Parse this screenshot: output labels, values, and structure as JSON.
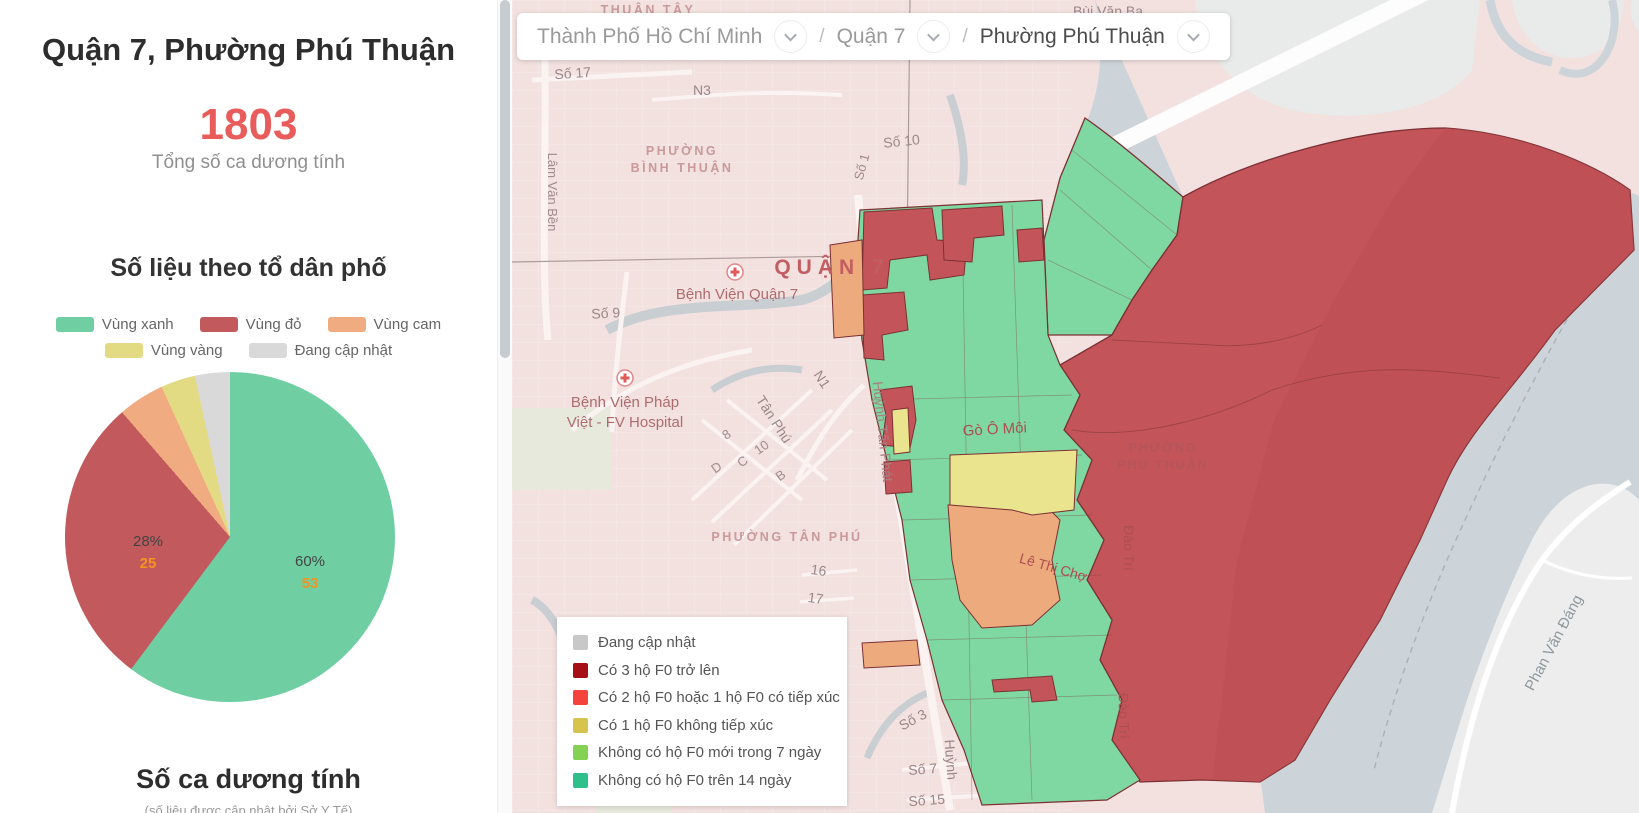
{
  "page": {
    "title": "Quận 7, Phường Phú Thuận"
  },
  "sidebar": {
    "title": "Quận 7, Phường Phú Thuận",
    "total_cases": "1803",
    "total_cases_label": "Tổng số ca dương tính",
    "section_title": "Số liệu theo tổ dân phố",
    "bottom_section_title": "Số ca dương tính",
    "bottom_section_subtitle": "(số liệu được cập nhật bởi Sở Y Tế)"
  },
  "chart_data": {
    "type": "pie",
    "title": "Số liệu theo tổ dân phố",
    "unit": "tổ dân phố",
    "start_angle": "12 o'clock",
    "direction": "clockwise",
    "legend_position": "top",
    "slices": [
      {
        "label": "Vùng xanh",
        "value": 53,
        "color": "#6fcfa3"
      },
      {
        "label": "Vùng đỏ",
        "value": 25,
        "color": "#c2595c"
      },
      {
        "label": "Vùng cam",
        "value": 4,
        "color": "#f1ab81"
      },
      {
        "label": "Vùng vàng",
        "value": 3,
        "color": "#e3da84"
      },
      {
        "label": "Đang cập nhật",
        "value": 3,
        "color": "#d9d9d9"
      }
    ],
    "displayed_labels": [
      {
        "slice": "Vùng xanh",
        "pct": "60%",
        "value": "53"
      },
      {
        "slice": "Vùng đỏ",
        "pct": "28%",
        "value": "25"
      }
    ]
  },
  "breadcrumb": {
    "separator": "/",
    "items": [
      {
        "label": "Thành Phố Hồ Chí Minh"
      },
      {
        "label": "Quận 7"
      },
      {
        "label": "Phường Phú Thuận"
      }
    ]
  },
  "map_legend": {
    "items": [
      {
        "label": "Đang cập nhật",
        "color": "#c8c8c8"
      },
      {
        "label": "Có 3 hộ F0 trở lên",
        "color": "#a50f15"
      },
      {
        "label": "Có 2 hộ F0 hoặc 1 hộ F0 có tiếp xúc",
        "color": "#f4433c"
      },
      {
        "label": "Có 1 hộ F0 không tiếp xúc",
        "color": "#d6c44f"
      },
      {
        "label": "Không có hộ F0 mới trong 7 ngày",
        "color": "#84d154"
      },
      {
        "label": "Không có hộ F0 trên 14 ngày",
        "color": "#2fbf8a"
      }
    ]
  },
  "map": {
    "labels": {
      "thuan_tay": "THUẬN TÂY",
      "bui_van_ba": "Bùi Văn Ba",
      "so_17": "Số 17",
      "n3": "N3",
      "so_1": "Số 1",
      "so_10": "Số 10",
      "phuong_binh_thuan_1": "PHƯỜNG",
      "phuong_binh_thuan_2": "BÌNH THUẬN",
      "lam_van_ben": "Lâm Văn Bền",
      "quan_7": "QUẬN 7",
      "bv_quan_7": "Bệnh Viện Quận 7",
      "so_9": "Số 9",
      "bv_fv_1": "Bệnh Viện Pháp",
      "bv_fv_2": "Việt - FV Hospital",
      "tan_phu": "Tân Phú",
      "n1": "N1",
      "d8": "8",
      "d10": "10",
      "dd": "D",
      "dc": "C",
      "db": "B",
      "phuong_tan_phu": "PHƯỜNG TÂN PHÚ",
      "n16": "16",
      "n17": "17",
      "huynh_tan_phat": "Huỳnh Tấn Phát",
      "go_o_moi": "Gò Ô Môi",
      "phuong_phu_thuan_1": "PHƯỜNG",
      "phuong_phu_thuan_2": "PHÚ THUẬN",
      "le_thi_cho": "Lê Thị Chợ",
      "dao_tri_1": "Đào Trí",
      "dao_tri_2": "Đào Trí",
      "phan_van_dang": "Phan Văn Đáng",
      "so_3": "Số 3",
      "so_7": "Số 7",
      "so_15": "Số 15",
      "huynh": "Huỳnh"
    }
  },
  "colors": {
    "accent_red": "#e85c5c",
    "value_orange": "#f59321",
    "map_water": "#ccd4d9",
    "map_land_pink": "#f2e1df",
    "map_zone_green": "#7fd7a2",
    "map_zone_red": "#c3555a",
    "map_zone_orange": "#edaa7c",
    "map_zone_yellow": "#e9e48d"
  }
}
